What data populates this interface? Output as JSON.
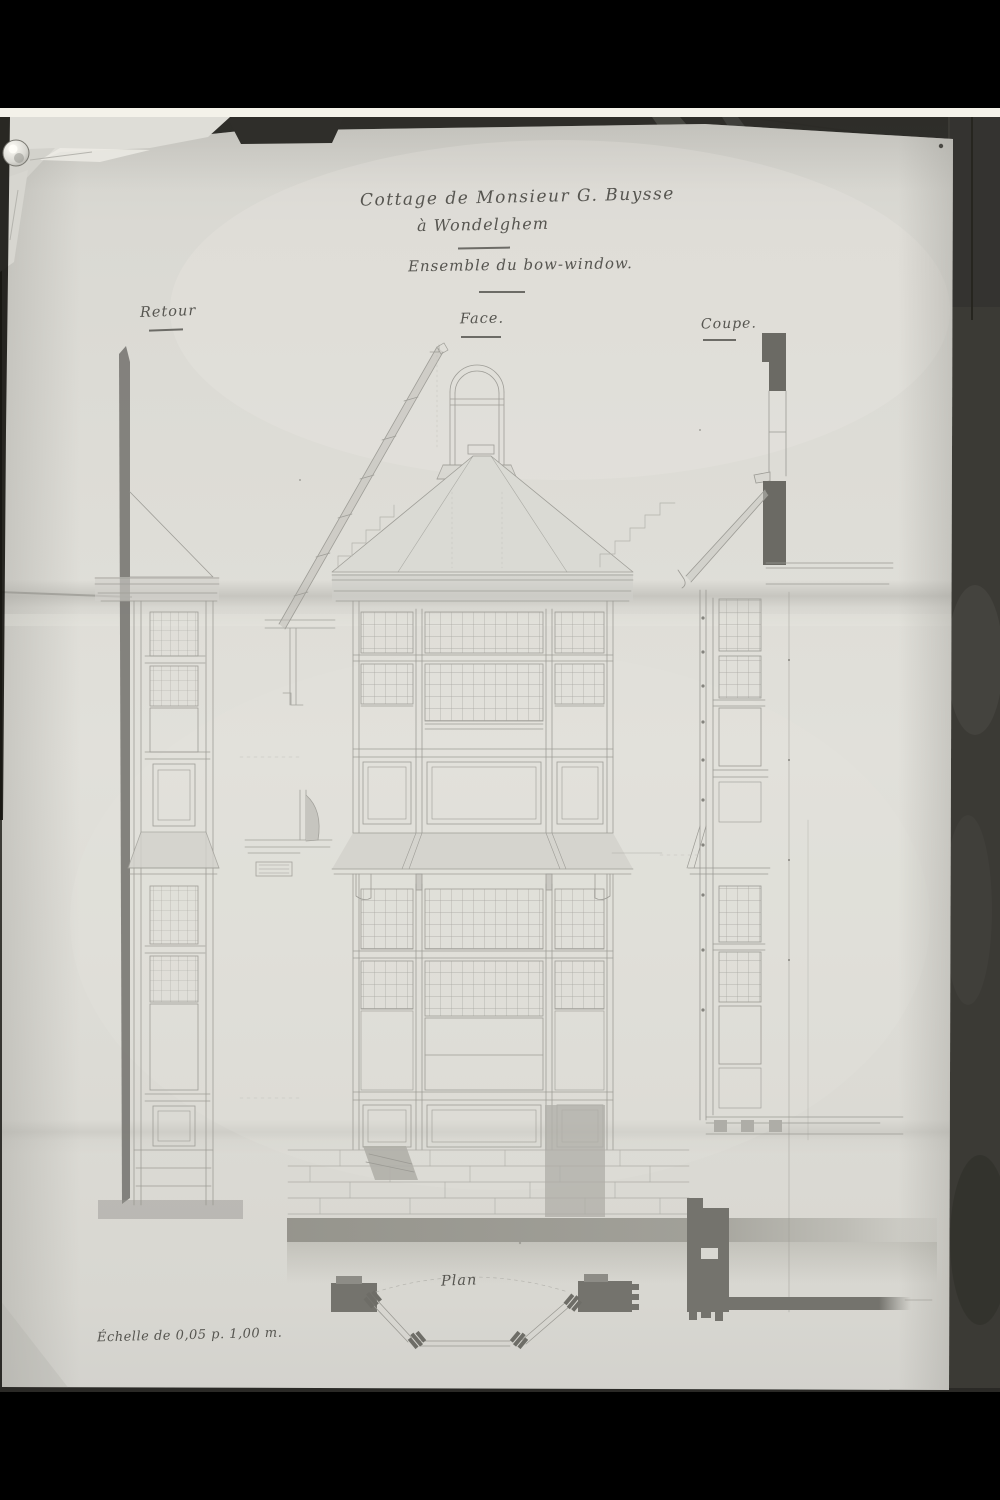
{
  "photo": {
    "description": "black-and-white photograph of a hand-drawn architectural sheet pinned to a wall",
    "titles": {
      "line1": "Cottage de Monsieur G. Buysse",
      "line2": "à Wondelghem",
      "subtitle": "Ensemble du bow-window."
    },
    "view_labels": {
      "retour": "Retour",
      "face": "Face.",
      "coupe": "Coupe.",
      "plan": "Plan"
    },
    "scale_note": "Échelle de 0,05 p. 1,00 m.",
    "views": [
      {
        "name": "Retour",
        "content": "side return elevation of the bow-window"
      },
      {
        "name": "Face",
        "content": "front elevation of the two-storey bow-window with hipped roof, arched attic window and stepped gable"
      },
      {
        "name": "Coupe",
        "content": "vertical section through wall and bow-window with dark poché masonry"
      },
      {
        "name": "Plan",
        "content": "plan of the canted bay with wall masses and corner mullions"
      }
    ],
    "colors": {
      "photo_border": "#000000",
      "film_strip": "#f4f2ea",
      "wall": "#3a3934",
      "paper": "#e0dfd9",
      "ink": "#565550",
      "pencil_line": "#a19f99",
      "poche": "#6b6a64",
      "wash": "#8e8d85"
    }
  }
}
